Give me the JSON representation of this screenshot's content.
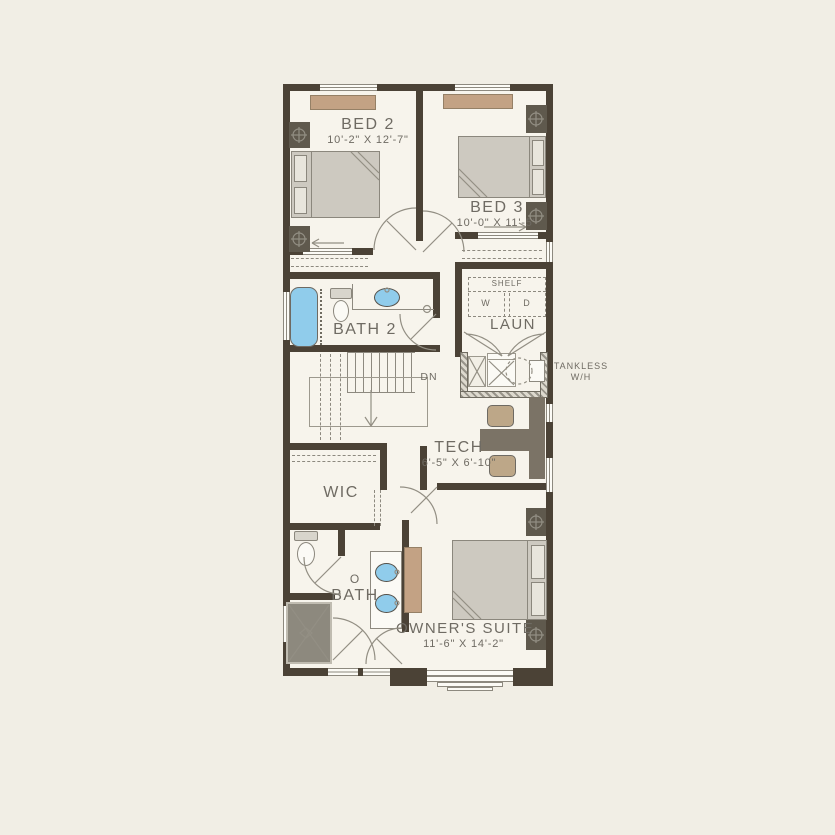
{
  "plan": {
    "bed2": {
      "name": "BED 2",
      "dims": "10'-2\" X 12'-7\""
    },
    "bed3": {
      "name": "BED 3",
      "dims": "10'-0\" X 11'-5\""
    },
    "bath2": {
      "name": "BATH 2"
    },
    "laundry": {
      "name": "LAUN",
      "shelf_label": "SHELF",
      "washer_label": "W",
      "dryer_label": "D"
    },
    "water_heater": {
      "label_line1": "TANKLESS",
      "label_line2": "W/H"
    },
    "stairs": {
      "direction_label": "DN"
    },
    "tech": {
      "name": "TECH",
      "dims": "6'-5\" X 6'-10\""
    },
    "wic": {
      "name": "WIC"
    },
    "owner_bath": {
      "name_line1": "O",
      "name_line2": "BATH"
    },
    "owner_suite": {
      "name": "OWNER'S SUITE",
      "dims": "11'-6\" X 14'-2\""
    }
  },
  "colors": {
    "page_background": "#f1eee5",
    "floor": "#f7f4ec",
    "wall": "#4b4236",
    "accent_tan": "#c3a284",
    "fixture_blue": "#90cceb",
    "furniture_gray": "#cdc9c0",
    "label_text": "#6f6b63"
  }
}
